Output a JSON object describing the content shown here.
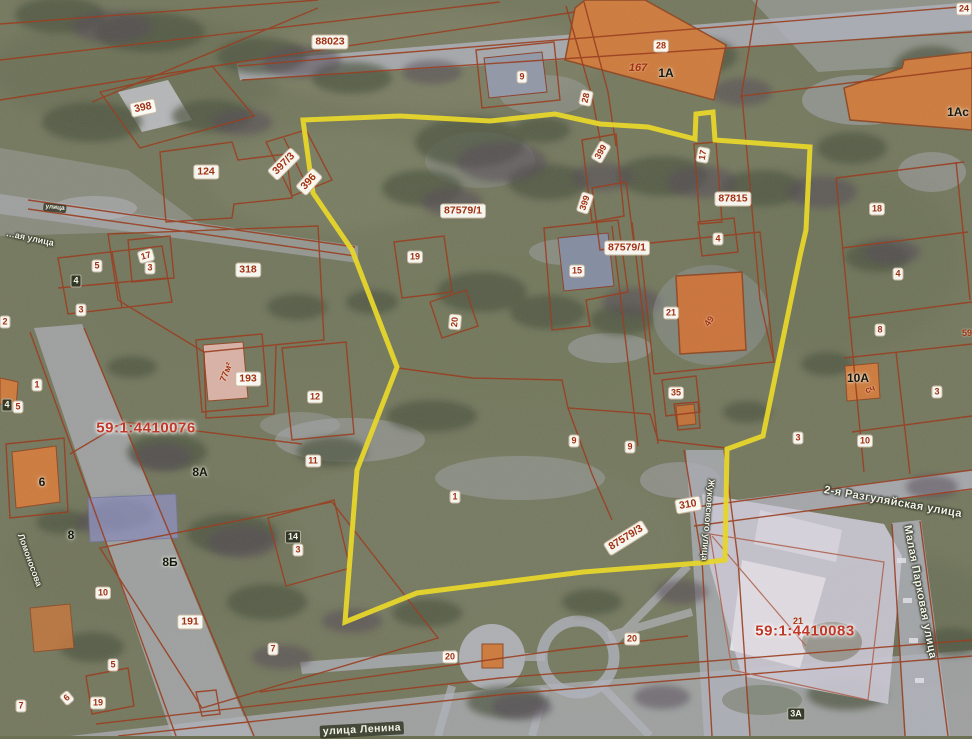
{
  "map": {
    "type": "cadastral-aerial-view",
    "cadastral_quarters": [
      "59:1:4410076",
      "59:1:4410083"
    ],
    "street_names": [
      "улица Ленина",
      "2-я Разгуляйская улица",
      "Малая Парковая улица",
      "Жуковского улица",
      "Ломоносова",
      "…ая улица"
    ],
    "zone_codes": [
      "88023",
      "87579/1",
      "87815",
      "87579/3",
      "310",
      "318",
      "191",
      "193",
      "124",
      "396",
      "397/3",
      "398",
      "399"
    ],
    "labels": [
      {
        "text": "88023",
        "x": 330,
        "y": 42,
        "style": "wbl"
      },
      {
        "text": "9",
        "x": 522,
        "y": 77,
        "style": "wb"
      },
      {
        "text": "28",
        "x": 661,
        "y": 46,
        "style": "wb"
      },
      {
        "text": "167",
        "x": 638,
        "y": 68,
        "style": "redi"
      },
      {
        "text": "1А",
        "x": 666,
        "y": 73,
        "style": "dk"
      },
      {
        "text": "24",
        "x": 964,
        "y": 9,
        "style": "wb"
      },
      {
        "text": "1Ас",
        "x": 958,
        "y": 112,
        "style": "dk"
      },
      {
        "text": "398",
        "x": 143,
        "y": 108,
        "rot": -12,
        "style": "wbl"
      },
      {
        "text": "124",
        "x": 206,
        "y": 172,
        "style": "wbl"
      },
      {
        "text": "397/3",
        "x": 284,
        "y": 164,
        "rot": -45,
        "style": "wbl"
      },
      {
        "text": "396",
        "x": 309,
        "y": 182,
        "rot": -48,
        "style": "wbl"
      },
      {
        "text": "28",
        "x": 586,
        "y": 98,
        "rot": -78,
        "style": "wb"
      },
      {
        "text": "399",
        "x": 601,
        "y": 152,
        "rot": -60,
        "style": "wb"
      },
      {
        "text": "399",
        "x": 585,
        "y": 203,
        "rot": -72,
        "style": "wb"
      },
      {
        "text": "87579/1",
        "x": 463,
        "y": 211,
        "style": "wbl"
      },
      {
        "text": "87579/1",
        "x": 627,
        "y": 248,
        "style": "wbl"
      },
      {
        "text": "87815",
        "x": 733,
        "y": 199,
        "style": "wbl"
      },
      {
        "text": "17",
        "x": 703,
        "y": 155,
        "rot": -80,
        "style": "wb"
      },
      {
        "text": "18",
        "x": 877,
        "y": 209,
        "style": "wb"
      },
      {
        "text": "4",
        "x": 718,
        "y": 239,
        "style": "wb"
      },
      {
        "text": "19",
        "x": 415,
        "y": 257,
        "style": "wb"
      },
      {
        "text": "15",
        "x": 577,
        "y": 271,
        "style": "wb"
      },
      {
        "text": "21",
        "x": 671,
        "y": 313,
        "style": "wb"
      },
      {
        "text": "49",
        "x": 709,
        "y": 321,
        "rot": -55,
        "style": "redp"
      },
      {
        "text": "4",
        "x": 898,
        "y": 274,
        "style": "wb"
      },
      {
        "text": "8",
        "x": 880,
        "y": 330,
        "style": "wb"
      },
      {
        "text": "59",
        "x": 967,
        "y": 333,
        "style": "redp"
      },
      {
        "text": "35",
        "x": 676,
        "y": 393,
        "style": "wb"
      },
      {
        "text": "10А",
        "x": 858,
        "y": 378,
        "style": "dk"
      },
      {
        "text": "сч",
        "x": 870,
        "y": 389,
        "rot": -20,
        "style": "redp"
      },
      {
        "text": "3",
        "x": 937,
        "y": 392,
        "style": "wb"
      },
      {
        "text": "10",
        "x": 865,
        "y": 441,
        "style": "wb"
      },
      {
        "text": "3",
        "x": 798,
        "y": 438,
        "style": "wb"
      },
      {
        "text": "9",
        "x": 574,
        "y": 441,
        "style": "wb"
      },
      {
        "text": "9",
        "x": 630,
        "y": 447,
        "style": "wb"
      },
      {
        "text": "12",
        "x": 315,
        "y": 397,
        "style": "wb"
      },
      {
        "text": "11",
        "x": 313,
        "y": 461,
        "style": "wb"
      },
      {
        "text": "318",
        "x": 248,
        "y": 270,
        "style": "wbl"
      },
      {
        "text": "193",
        "x": 248,
        "y": 379,
        "style": "wbl"
      },
      {
        "text": "77м²",
        "x": 226,
        "y": 372,
        "rot": -68,
        "style": "redp"
      },
      {
        "text": "5",
        "x": 97,
        "y": 266,
        "style": "wb"
      },
      {
        "text": "4",
        "x": 76,
        "y": 281,
        "style": "inv"
      },
      {
        "text": "3",
        "x": 81,
        "y": 310,
        "style": "wb"
      },
      {
        "text": "17",
        "x": 146,
        "y": 256,
        "rot": -15,
        "style": "wb"
      },
      {
        "text": "3",
        "x": 150,
        "y": 268,
        "style": "wb"
      },
      {
        "text": "2",
        "x": 5,
        "y": 322,
        "style": "wb"
      },
      {
        "text": "1",
        "x": 37,
        "y": 385,
        "style": "wb"
      },
      {
        "text": "4",
        "x": 7,
        "y": 405,
        "style": "inv"
      },
      {
        "text": "5",
        "x": 18,
        "y": 407,
        "style": "wb"
      },
      {
        "text": "20",
        "x": 455,
        "y": 322,
        "rot": -85,
        "style": "wb"
      },
      {
        "text": "59:1:4410076",
        "x": 146,
        "y": 428,
        "style": "qtr"
      },
      {
        "text": "6",
        "x": 42,
        "y": 482,
        "style": "dk"
      },
      {
        "text": "8А",
        "x": 200,
        "y": 472,
        "style": "dk"
      },
      {
        "text": "8",
        "x": 71,
        "y": 535,
        "style": "dk"
      },
      {
        "text": "8Б",
        "x": 170,
        "y": 562,
        "style": "dk"
      },
      {
        "text": "14",
        "x": 293,
        "y": 537,
        "style": "inv"
      },
      {
        "text": "3",
        "x": 298,
        "y": 550,
        "style": "wb"
      },
      {
        "text": "10",
        "x": 103,
        "y": 593,
        "style": "wb"
      },
      {
        "text": "191",
        "x": 190,
        "y": 622,
        "style": "wbl"
      },
      {
        "text": "1",
        "x": 455,
        "y": 497,
        "style": "wb"
      },
      {
        "text": "310",
        "x": 688,
        "y": 505,
        "rot": -10,
        "style": "wbl"
      },
      {
        "text": "87579/3",
        "x": 626,
        "y": 538,
        "rot": -32,
        "style": "wbl"
      },
      {
        "text": "5",
        "x": 113,
        "y": 665,
        "style": "wb"
      },
      {
        "text": "6",
        "x": 67,
        "y": 698,
        "rot": -40,
        "style": "wb"
      },
      {
        "text": "19",
        "x": 98,
        "y": 703,
        "style": "wb"
      },
      {
        "text": "7",
        "x": 21,
        "y": 706,
        "style": "wb"
      },
      {
        "text": "7",
        "x": 273,
        "y": 649,
        "style": "wb"
      },
      {
        "text": "20",
        "x": 450,
        "y": 657,
        "style": "wb"
      },
      {
        "text": "20",
        "x": 632,
        "y": 639,
        "style": "wb"
      },
      {
        "text": "21",
        "x": 798,
        "y": 621,
        "style": "redp"
      },
      {
        "text": "59:1:4410083",
        "x": 805,
        "y": 631,
        "style": "qtr"
      },
      {
        "text": "3А",
        "x": 796,
        "y": 714,
        "style": "inv"
      },
      {
        "text": "улица Ленина",
        "x": 362,
        "y": 730,
        "rot": -3,
        "style": "stb"
      },
      {
        "text": "улица",
        "x": 55,
        "y": 208,
        "rot": 6,
        "style": "stbsm"
      },
      {
        "text": "…ая улица",
        "x": 30,
        "y": 238,
        "rot": 12,
        "style": "stwsm"
      },
      {
        "text": "Ломоносова",
        "x": 30,
        "y": 560,
        "rot": 70,
        "style": "stwsm"
      },
      {
        "text": "Жуковского улица",
        "x": 708,
        "y": 520,
        "rot": 95,
        "style": "stwsm"
      },
      {
        "text": "2-я Разгуляйская улица",
        "x": 893,
        "y": 502,
        "rot": 10,
        "style": "stw"
      },
      {
        "text": "Малая Парковая улица",
        "x": 920,
        "y": 592,
        "rot": 79,
        "style": "stw"
      }
    ],
    "colors": {
      "boundary_highlight": "#f0dc14",
      "parcel_lines": "#962b08",
      "ground": "#6d7154",
      "roads": "#b0b3be",
      "buildings_orange": "#d2742e",
      "building_pink": "#dfb3a4",
      "label_red": "#a33012"
    }
  }
}
